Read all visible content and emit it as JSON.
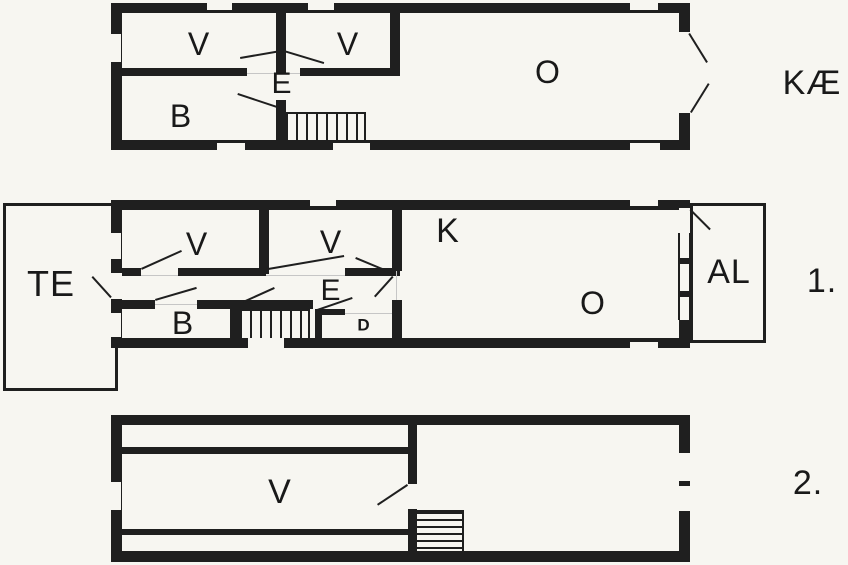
{
  "colors": {
    "wall": "#1f1f1f",
    "background": "#f7f6f1",
    "guide_line": "#c6c6c6"
  },
  "floors": {
    "basement": {
      "tag": "KÆ",
      "rooms": {
        "v1": "V",
        "v2": "V",
        "hall": "E",
        "bath": "B",
        "living": "O"
      }
    },
    "first": {
      "tag": "1.",
      "terrace": "TE",
      "balcony": "AL",
      "rooms": {
        "v1": "V",
        "v2": "V",
        "kitchen": "K",
        "hall": "E",
        "bath": "B",
        "wc": "D",
        "living": "O"
      }
    },
    "second": {
      "tag": "2.",
      "rooms": {
        "room": "V"
      }
    }
  }
}
